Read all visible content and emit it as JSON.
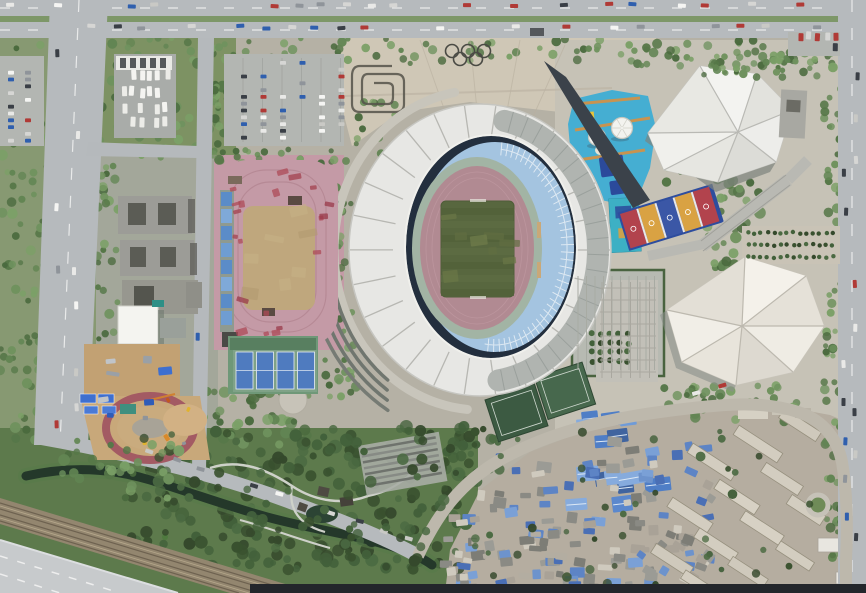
{
  "meta": {
    "description": "aerial satellite view of a sports complex: oval stadium with white crescent roof, athletics training track, tennis courts, faceted-roof gymnasium and natatorium, rooftop play deck with domes, Olympic rings plaza, spiral garden, bus depot, parking lots, park with river, railway, highway, and dense urban village with blue roofs",
    "colors": {
      "plaza": "#cfc7b6",
      "road": "#b6babd",
      "stadium_roof": "#e7e7e4",
      "stadium_upper_roof": "#b0b4b0",
      "seats": "#a4c4e0",
      "bowl_shadow": "#232f3e",
      "sage_ring": "#a2b4a4",
      "track": "#b18a92",
      "pitch": "#58673f",
      "training_track": "#c49aa6",
      "infield": "#bfa77d",
      "tennis_green": "#6f9878",
      "tennis_court": "#4f7bbf",
      "deck_blue": "#45aed2",
      "gym_roof": "#e9e9e5",
      "natatorium_roof": "#ebe7df",
      "village_base": "#b5ada0",
      "river": "#24382a",
      "railway": "#93866f",
      "highway": "#c7cacc",
      "park_green": "#5d7a4c",
      "east_plaza": "#c6c2b6",
      "dark_strip": "#23262b"
    }
  },
  "palettes": {
    "greens": [
      "#4a6a3e",
      "#567748",
      "#628553",
      "#6f925e",
      "#7ba067"
    ],
    "darkgreens": [
      "#39512f",
      "#42603a",
      "#4b6a42",
      "#35492c"
    ],
    "cars": [
      "#f5f5f3",
      "#e9e9e7",
      "#d6d6d4",
      "#3a3f46",
      "#8f949a",
      "#b03a36",
      "#2f5fae",
      "#c9c9c5"
    ],
    "buses": [
      "#f4f4f1",
      "#ecece8"
    ],
    "warehouse": [
      "#4f7ec6",
      "#6f9bd8",
      "#40649f",
      "#86abdd",
      "#5b88cd"
    ],
    "village": [
      "#5d84c5",
      "#7aa0d6",
      "#4a6fb5",
      "#9b9b95",
      "#b3ada1",
      "#8a8a84",
      "#cfcabe",
      "#6d93cc",
      "#7d7d76",
      "#a9a297"
    ],
    "redpatch": [
      "#a3404e",
      "#99394a",
      "#ad4a57"
    ],
    "dirt": [
      "#b29a6f",
      "#c7b086"
    ],
    "pitch": [
      "#6b7847",
      "#616e41",
      "#707d4b"
    ],
    "tarps": [
      "#3e6fd0",
      "#9aa0a6",
      "#c0c4c8",
      "#2f5cb8"
    ],
    "machines": [
      "#d98a2b",
      "#e0b32e",
      "#8f949a",
      "#c2571f"
    ]
  },
  "gen": [
    {
      "t": "scatter",
      "g": "g-trees",
      "x": 96,
      "y": 38,
      "w": 560,
      "h": 26,
      "n": 70,
      "r": [
        2.5,
        5
      ],
      "p": "greens",
      "name": "tree"
    },
    {
      "t": "scatter",
      "g": "g-trees",
      "x": 640,
      "y": 40,
      "w": 196,
      "h": 28,
      "n": 55,
      "r": [
        2.5,
        5
      ],
      "p": "greens",
      "name": "tree"
    },
    {
      "t": "scatter",
      "g": "g-trees",
      "x": 96,
      "y": 62,
      "w": 128,
      "h": 98,
      "n": 60,
      "r": [
        3,
        6
      ],
      "p": "greens",
      "name": "tree"
    },
    {
      "t": "scatter",
      "g": "g-trees",
      "x": 0,
      "y": 40,
      "w": 55,
      "h": 400,
      "n": 90,
      "r": [
        2.5,
        5.5
      ],
      "p": "greens",
      "name": "tree"
    },
    {
      "t": "scatter",
      "g": "g-trees",
      "x": 96,
      "y": 160,
      "w": 24,
      "h": 280,
      "n": 45,
      "r": [
        2.5,
        5
      ],
      "p": "greens",
      "name": "tree"
    },
    {
      "t": "scatter",
      "g": "g-trees",
      "x": 212,
      "y": 40,
      "w": 22,
      "h": 128,
      "n": 22,
      "r": [
        2.5,
        5
      ],
      "p": "greens",
      "name": "tree"
    },
    {
      "t": "scatter",
      "g": "g-trees",
      "x": 230,
      "y": 148,
      "w": 105,
      "h": 16,
      "n": 16,
      "r": [
        2.5,
        4.5
      ],
      "p": "greens",
      "name": "tree"
    },
    {
      "t": "scatter",
      "g": "g-trees",
      "x": 336,
      "y": 160,
      "w": 18,
      "h": 190,
      "n": 26,
      "r": [
        2.5,
        4.5
      ],
      "p": "greens",
      "name": "tree"
    },
    {
      "t": "scatter",
      "g": "g-trees",
      "x": 196,
      "y": 390,
      "w": 120,
      "h": 55,
      "n": 40,
      "r": [
        3,
        6
      ],
      "p": "greens",
      "name": "tree"
    },
    {
      "t": "scatter",
      "g": "g-trees",
      "x": 130,
      "y": 425,
      "w": 340,
      "h": 145,
      "n": 170,
      "r": [
        3.5,
        7
      ],
      "p": "darkgreens",
      "name": "tree"
    },
    {
      "t": "scatter",
      "g": "g-trees",
      "x": 440,
      "y": 425,
      "w": 60,
      "h": 60,
      "n": 25,
      "r": [
        3,
        6
      ],
      "p": "darkgreens",
      "name": "tree"
    },
    {
      "t": "scatter",
      "g": "g-trees",
      "x": 700,
      "y": 175,
      "w": 70,
      "h": 95,
      "n": 45,
      "r": [
        3,
        6
      ],
      "p": "greens",
      "name": "tree"
    },
    {
      "t": "scatter",
      "g": "g-trees",
      "x": 824,
      "y": 40,
      "w": 18,
      "h": 540,
      "n": 70,
      "r": [
        2.5,
        5
      ],
      "p": "greens",
      "name": "tree"
    },
    {
      "t": "scatter",
      "g": "g-trees",
      "x": 655,
      "y": 128,
      "w": 48,
      "h": 55,
      "n": 16,
      "r": [
        2.5,
        5
      ],
      "p": "greens",
      "name": "tree"
    },
    {
      "t": "scatter",
      "g": "g-trees",
      "x": 660,
      "y": 385,
      "w": 140,
      "h": 38,
      "n": 35,
      "r": [
        3,
        5.5
      ],
      "p": "greens",
      "name": "tree"
    },
    {
      "t": "scatter",
      "g": "g-trees",
      "x": 300,
      "y": 355,
      "w": 60,
      "h": 45,
      "n": 22,
      "r": [
        2.5,
        5
      ],
      "p": "greens",
      "name": "tree"
    },
    {
      "t": "scatter",
      "g": "g-trees",
      "x": 352,
      "y": 100,
      "w": 45,
      "h": 55,
      "n": 14,
      "r": [
        2.5,
        4.5
      ],
      "p": "greens",
      "name": "tree"
    },
    {
      "t": "scatter",
      "g": "g-trees",
      "x": 0,
      "y": 14,
      "w": 866,
      "h": 8,
      "n": 45,
      "r": [
        1.8,
        3
      ],
      "p": "greens",
      "name": "median-tree"
    },
    {
      "t": "grid",
      "g": "g-trees",
      "x": 233,
      "y": 60,
      "cols": 6,
      "rows": 10,
      "dx": 19.5,
      "dy": 8.6,
      "r": 2.6,
      "p": "greens",
      "name": "parking-tree"
    },
    {
      "t": "rects",
      "g": "g-vill",
      "x": 575,
      "y": 418,
      "w": 85,
      "h": 88,
      "n": 14,
      "ws": [
        16,
        30
      ],
      "hs": [
        9,
        16
      ],
      "rot": [
        -10,
        -4
      ],
      "p": "warehouse",
      "name": "warehouse-roof"
    },
    {
      "t": "rects",
      "g": "g-vill",
      "x": 458,
      "y": 438,
      "w": 250,
      "h": 148,
      "n": 95,
      "ws": [
        7,
        15
      ],
      "hs": [
        5,
        11
      ],
      "rot": [
        -12,
        8
      ],
      "p": "village",
      "name": "village-roof"
    },
    {
      "t": "rects",
      "g": "g-vill",
      "x": 445,
      "y": 518,
      "w": 160,
      "h": 70,
      "n": 40,
      "ws": [
        7,
        14
      ],
      "hs": [
        5,
        10
      ],
      "rot": [
        -8,
        10
      ],
      "p": "village",
      "name": "village-roof"
    },
    {
      "t": "rects",
      "g": "g-vill",
      "x": 640,
      "y": 468,
      "w": 80,
      "h": 112,
      "n": 22,
      "ws": [
        7,
        13
      ],
      "hs": [
        5,
        10
      ],
      "rot": [
        20,
        40
      ],
      "p": "village",
      "name": "village-roof"
    },
    {
      "t": "band",
      "g": "g-arcs",
      "cx": 480,
      "cy": 250,
      "rx": 146,
      "ry": 160,
      "a0": 95,
      "a1": 262,
      "sw": 9,
      "c": "#c8c5bb",
      "name": "ring-walkway"
    },
    {
      "t": "band",
      "g": "g-arcs",
      "cx": 480,
      "cy": 250,
      "rx": 150,
      "ry": 165,
      "a0": 128,
      "a1": 198,
      "sw": 3.5,
      "c": "#70766f",
      "name": "terrace-arc"
    },
    {
      "t": "band",
      "g": "g-arcs",
      "cx": 480,
      "cy": 250,
      "rx": 158,
      "ry": 173,
      "a0": 126,
      "a1": 196,
      "sw": 3.5,
      "c": "#70766f",
      "name": "terrace-arc"
    },
    {
      "t": "band",
      "g": "g-arcs",
      "cx": 480,
      "cy": 250,
      "rx": 166,
      "ry": 181,
      "a0": 124,
      "a1": 194,
      "sw": 3.5,
      "c": "#70766f",
      "name": "terrace-arc"
    },
    {
      "t": "band",
      "g": "g-arcs",
      "cx": 480,
      "cy": 250,
      "rx": 174,
      "ry": 189,
      "a0": 122,
      "a1": 192,
      "sw": 3.5,
      "c": "#767b74",
      "name": "terrace-arc"
    },
    {
      "t": "rects",
      "g": "g-trackpatch",
      "x": 224,
      "y": 170,
      "w": 100,
      "h": 26,
      "n": 5,
      "ws": [
        5,
        14
      ],
      "hs": [
        3,
        8
      ],
      "rot": [
        -20,
        20
      ],
      "p": "redpatch",
      "o": 0.75,
      "name": "track-patch"
    },
    {
      "t": "rects",
      "g": "g-trackpatch",
      "x": 224,
      "y": 196,
      "w": 22,
      "h": 110,
      "n": 5,
      "ws": [
        4,
        10
      ],
      "hs": [
        3,
        8
      ],
      "rot": [
        -20,
        20
      ],
      "p": "redpatch",
      "o": 0.75,
      "name": "track-patch"
    },
    {
      "t": "rects",
      "g": "g-trackpatch",
      "x": 312,
      "y": 200,
      "w": 20,
      "h": 100,
      "n": 4,
      "ws": [
        4,
        10
      ],
      "hs": [
        3,
        8
      ],
      "rot": [
        -20,
        20
      ],
      "p": "redpatch",
      "o": 0.75,
      "name": "track-patch"
    },
    {
      "t": "rects",
      "g": "g-trackpatch",
      "x": 230,
      "y": 300,
      "w": 95,
      "h": 34,
      "n": 6,
      "ws": [
        5,
        14
      ],
      "hs": [
        3,
        8
      ],
      "rot": [
        -20,
        20
      ],
      "p": "redpatch",
      "o": 0.75,
      "name": "track-patch"
    },
    {
      "t": "rects",
      "g": "g-infield",
      "x": 246,
      "y": 210,
      "w": 64,
      "h": 92,
      "n": 7,
      "ws": [
        10,
        24
      ],
      "hs": [
        6,
        14
      ],
      "rot": [
        -15,
        15
      ],
      "p": "dirt",
      "o": 0.6,
      "name": "infield-patch"
    },
    {
      "t": "rects",
      "g": "g-cons",
      "x": 92,
      "y": 350,
      "w": 80,
      "h": 66,
      "n": 7,
      "ws": [
        6,
        14
      ],
      "hs": [
        4,
        9
      ],
      "rot": [
        -10,
        10
      ],
      "p": "tarps",
      "name": "construction-item"
    },
    {
      "t": "rects",
      "g": "g-cons",
      "x": 135,
      "y": 400,
      "w": 55,
      "h": 45,
      "n": 6,
      "ws": [
        3,
        7
      ],
      "hs": [
        3,
        5
      ],
      "rot": [
        0,
        90
      ],
      "p": "machines",
      "name": "construction-vehicle"
    },
    {
      "t": "ribs",
      "g": "g-stad-ribs",
      "cx": 480,
      "cy": 250,
      "r1": [
        87,
        109
      ],
      "r2": [
        130,
        145
      ],
      "a0": 0,
      "a1": 347,
      "s": 13.85,
      "sw": 1.3,
      "c": "#b7b7b2",
      "name": "roof-rib"
    },
    {
      "t": "band",
      "g": "g-stad-band",
      "cx": 480,
      "cy": 250,
      "rx": 118,
      "ry": 132,
      "a0": -78,
      "a1": 82,
      "sw": 22,
      "c": "#b0b4b0",
      "name": "upper-tier-roof"
    },
    {
      "t": "ribs",
      "g": "g-stad-band",
      "cx": 480,
      "cy": 250,
      "r1": [
        108,
        122
      ],
      "r2": [
        129,
        143
      ],
      "a0": -75,
      "a1": 80,
      "s": 7,
      "sw": 1,
      "c": "#9aa09c",
      "name": "upper-roof-rib"
    },
    {
      "t": "ribs",
      "g": "g-stad-seatl",
      "cx": 495,
      "cy": 247,
      "r1": [
        66,
        92
      ],
      "r2": [
        79,
        105
      ],
      "a0": -85,
      "a1": 98,
      "s": 4.4,
      "sw": 0.9,
      "c": "#e2ecf4",
      "name": "seat-divider"
    },
    {
      "t": "band",
      "g": "g-stad-seatl",
      "cx": 495,
      "cy": 247,
      "rx": 72,
      "ry": 98,
      "a0": -85,
      "a1": 98,
      "sw": 1,
      "c": "#dce8f2",
      "name": "seat-tier-line"
    },
    {
      "t": "rects",
      "g": "g-pitchpatch",
      "x": 444,
      "y": 206,
      "w": 66,
      "h": 86,
      "n": 8,
      "ws": [
        8,
        22
      ],
      "hs": [
        5,
        12
      ],
      "rot": [
        -10,
        10
      ],
      "p": "pitch",
      "o": 0.7,
      "name": "pitch-patch"
    },
    {
      "t": "ribs",
      "g": "g-domelines",
      "cx": 597,
      "cy": 137,
      "r1": [
        1,
        1
      ],
      "r2": [
        8,
        8
      ],
      "a0": 0,
      "a1": 300,
      "s": 60,
      "sw": 0.8,
      "c": "#d2d2ca",
      "name": "dome-seam"
    },
    {
      "t": "ribs",
      "g": "g-domelines",
      "cx": 622,
      "cy": 128,
      "r1": [
        1,
        1
      ],
      "r2": [
        10,
        10
      ],
      "a0": 0,
      "a1": 300,
      "s": 60,
      "sw": 0.8,
      "c": "#d2d2ca",
      "name": "dome-seam"
    },
    {
      "t": "grid",
      "g": "g-misc",
      "x": 748,
      "y": 233,
      "cols": 14,
      "rows": 3,
      "dx": 6.5,
      "dy": 12,
      "r": 2.2,
      "p": "darkgreens",
      "name": "garden-shrub"
    },
    {
      "t": "grid",
      "g": "g-misc",
      "x": 592,
      "y": 334,
      "cols": 5,
      "rows": 4,
      "dx": 9,
      "dy": 9,
      "r": 3,
      "p": "darkgreens",
      "name": "parking-tree"
    },
    {
      "t": "vlines",
      "g": "g-misc",
      "x": 578,
      "y": 276,
      "len": 94,
      "n": 10,
      "d": 8.5,
      "sw": 1,
      "c": "#a8aba3",
      "name": "parking-line"
    },
    {
      "t": "vlines",
      "g": "g-misc",
      "x": 602,
      "y": 282,
      "len": 96,
      "n": 6,
      "d": 9.5,
      "sw": 1,
      "c": "#a9a79f",
      "name": "hedge-grid-line"
    },
    {
      "t": "hlines",
      "g": "g-misc",
      "x": 600,
      "y": 288,
      "len": 56,
      "n": 8,
      "d": 12,
      "sw": 1,
      "c": "#aaa8a0",
      "name": "hedge-grid-line"
    },
    {
      "t": "vlines",
      "g": "g-misc",
      "x": 243,
      "y": 58,
      "len": 84,
      "n": 6,
      "d": 19.5,
      "sw": 1,
      "c": "#a4a7a3",
      "name": "parking-line"
    },
    {
      "t": "cars",
      "g": "g-cars",
      "x": 10,
      "y": 5,
      "dx": 24,
      "dy": 0,
      "n": 34,
      "w": 8,
      "h": 4,
      "p": "cars",
      "k": 0.45,
      "name": "car"
    },
    {
      "t": "cars",
      "g": "g-cars",
      "x": 16,
      "y": 27,
      "dx": 25,
      "dy": 0,
      "n": 33,
      "w": 8,
      "h": 4,
      "p": "cars",
      "k": 0.4,
      "name": "car"
    },
    {
      "t": "cars",
      "g": "g-cars",
      "x": 58,
      "y": 52,
      "dx": 0,
      "dy": 31,
      "n": 13,
      "w": 4,
      "h": 8,
      "p": "cars",
      "k": 0.5,
      "name": "car"
    },
    {
      "t": "cars",
      "g": "g-cars",
      "x": 76,
      "y": 66,
      "dx": 0,
      "dy": 34,
      "n": 11,
      "w": 4,
      "h": 8,
      "p": "cars",
      "k": 0.55,
      "name": "car"
    },
    {
      "t": "cars",
      "g": "g-cars",
      "x": 845,
      "y": 60,
      "dx": 0,
      "dy": 38,
      "n": 13,
      "w": 4,
      "h": 8,
      "p": "cars",
      "k": 0.5,
      "name": "car"
    },
    {
      "t": "cars",
      "g": "g-cars",
      "x": 856,
      "y": 75,
      "dx": 0,
      "dy": 42,
      "n": 12,
      "w": 4,
      "h": 8,
      "p": "cars",
      "k": 0.6,
      "name": "car"
    },
    {
      "t": "cars",
      "g": "g-cars",
      "x": 199,
      "y": 60,
      "dx": 0,
      "dy": 46,
      "n": 8,
      "w": 4,
      "h": 8,
      "p": "cars",
      "k": 0.55,
      "name": "car"
    },
    {
      "t": "cars",
      "g": "g-cars",
      "x": 150,
      "y": 450,
      "dx": 26,
      "dy": 9,
      "n": 11,
      "w": 8,
      "h": 4,
      "p": "cars",
      "k": 0.3,
      "rot": 18,
      "name": "car"
    },
    {
      "t": "cars",
      "g": "g-cars",
      "x": 560,
      "y": 434,
      "dx": 27,
      "dy": -8,
      "n": 8,
      "w": 8,
      "h": 4,
      "p": "cars",
      "k": 0.5,
      "rot": -15,
      "name": "car"
    },
    {
      "t": "cars",
      "g": "g-cars",
      "x": 790,
      "y": 36,
      "dx": 9,
      "dy": 0,
      "n": 6,
      "w": 5,
      "h": 8,
      "p": "cars",
      "k": 0.3,
      "name": "car"
    },
    {
      "t": "cars",
      "g": "g-cars",
      "x": 790,
      "y": 47,
      "dx": 9,
      "dy": 0,
      "n": 6,
      "w": 5,
      "h": 8,
      "p": "cars",
      "k": 0.4,
      "name": "car"
    },
    {
      "t": "pcols",
      "g": "g-cars",
      "x": 241,
      "y": 61,
      "cols": 6,
      "dcol": 19.5,
      "n": 12,
      "dy": 6.8,
      "w": 6,
      "h": 3.8,
      "p": "cars",
      "k": 0.4,
      "name": "parked-car"
    },
    {
      "t": "pcols",
      "g": "g-cars",
      "x": 8,
      "y": 64,
      "cols": 2,
      "dcol": 17,
      "n": 12,
      "dy": 6.8,
      "w": 6,
      "h": 3.8,
      "p": "cars",
      "k": 0.5,
      "name": "parked-car"
    },
    {
      "t": "cars",
      "g": "g-cars",
      "x": 124,
      "y": 76,
      "dx": 8.5,
      "dy": 0,
      "n": 6,
      "w": 5,
      "h": 10,
      "p": "buses",
      "k": 0.1,
      "name": "bus"
    },
    {
      "t": "cars",
      "g": "g-cars",
      "x": 124,
      "y": 92,
      "dx": 8.5,
      "dy": 0,
      "n": 6,
      "w": 5,
      "h": 10,
      "p": "buses",
      "k": 0.15,
      "name": "bus"
    },
    {
      "t": "cars",
      "g": "g-cars",
      "x": 124,
      "y": 108,
      "dx": 8.5,
      "dy": 0,
      "n": 6,
      "w": 5,
      "h": 10,
      "p": "buses",
      "k": 0.15,
      "name": "bus"
    },
    {
      "t": "cars",
      "g": "g-cars",
      "x": 124,
      "y": 122,
      "dx": 8.5,
      "dy": 0,
      "n": 6,
      "w": 5,
      "h": 10,
      "p": "buses",
      "k": 0.2,
      "name": "bus"
    },
    {
      "t": "scatter",
      "g": "g-trees2",
      "x": 140,
      "y": 430,
      "w": 310,
      "h": 120,
      "n": 60,
      "r": [
        3,
        6
      ],
      "p": "darkgreens",
      "name": "tree"
    },
    {
      "t": "scatter",
      "g": "g-trees2",
      "x": 60,
      "y": 440,
      "w": 120,
      "h": 58,
      "n": 30,
      "r": [
        3,
        6
      ],
      "p": "greens",
      "name": "tree"
    },
    {
      "t": "scatter",
      "g": "g-trees2",
      "x": 230,
      "y": 518,
      "w": 200,
      "h": 52,
      "n": 45,
      "r": [
        3,
        6
      ],
      "p": "darkgreens",
      "name": "tree"
    },
    {
      "t": "scatter",
      "g": "g-trees2",
      "x": 455,
      "y": 430,
      "w": 395,
      "h": 155,
      "n": 42,
      "r": [
        2.5,
        5
      ],
      "p": "darkgreens",
      "name": "tree"
    },
    {
      "t": "scatter",
      "g": "g-trees2",
      "x": 690,
      "y": 58,
      "w": 130,
      "h": 20,
      "n": 25,
      "r": [
        2.5,
        4.5
      ],
      "p": "greens",
      "name": "tree"
    }
  ]
}
